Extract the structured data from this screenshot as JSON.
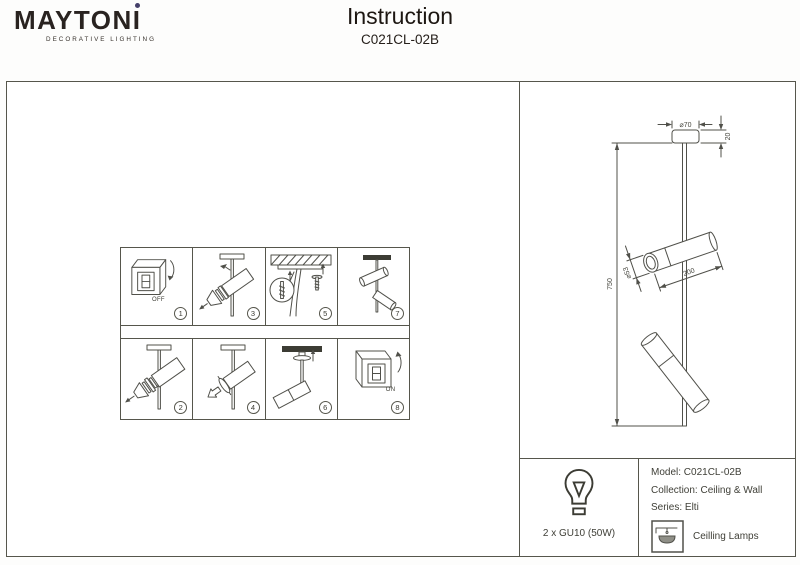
{
  "header": {
    "brand": "MAYTONI",
    "tagline": "DECORATIVE LIGHTING",
    "doc_title": "Instruction",
    "doc_model": "C021CL-02B",
    "accent_color": "#45406a"
  },
  "steps": {
    "row1": [
      {
        "number": "1",
        "caption": "OFF",
        "name": "turn-power-off"
      },
      {
        "number": "3",
        "caption": "",
        "name": "unscrew-spot-head"
      },
      {
        "number": "5",
        "caption": "",
        "name": "install-ceiling-anchors"
      },
      {
        "number": "7",
        "caption": "",
        "name": "assembled-fixture"
      }
    ],
    "row2": [
      {
        "number": "2",
        "caption": "",
        "name": "disassemble-spot-parts"
      },
      {
        "number": "4",
        "caption": "",
        "name": "reattach-spot-head"
      },
      {
        "number": "6",
        "caption": "",
        "name": "fix-canopy-to-ceiling"
      },
      {
        "number": "8",
        "caption": "ON",
        "name": "turn-power-on"
      }
    ]
  },
  "drawing": {
    "dim_canopy_diameter": "⌀70",
    "dim_canopy_height": "20",
    "dim_overall_height": "750",
    "dim_spot_diameter": "⌀53",
    "dim_spot_length": "200"
  },
  "spec": {
    "lamp_info": "2 x GU10 (50W)",
    "model": "Model: C021CL-02B",
    "collection": "Collection: Ceiling & Wall",
    "series": "Series: Elti",
    "category": "Ceilling Lamps"
  }
}
